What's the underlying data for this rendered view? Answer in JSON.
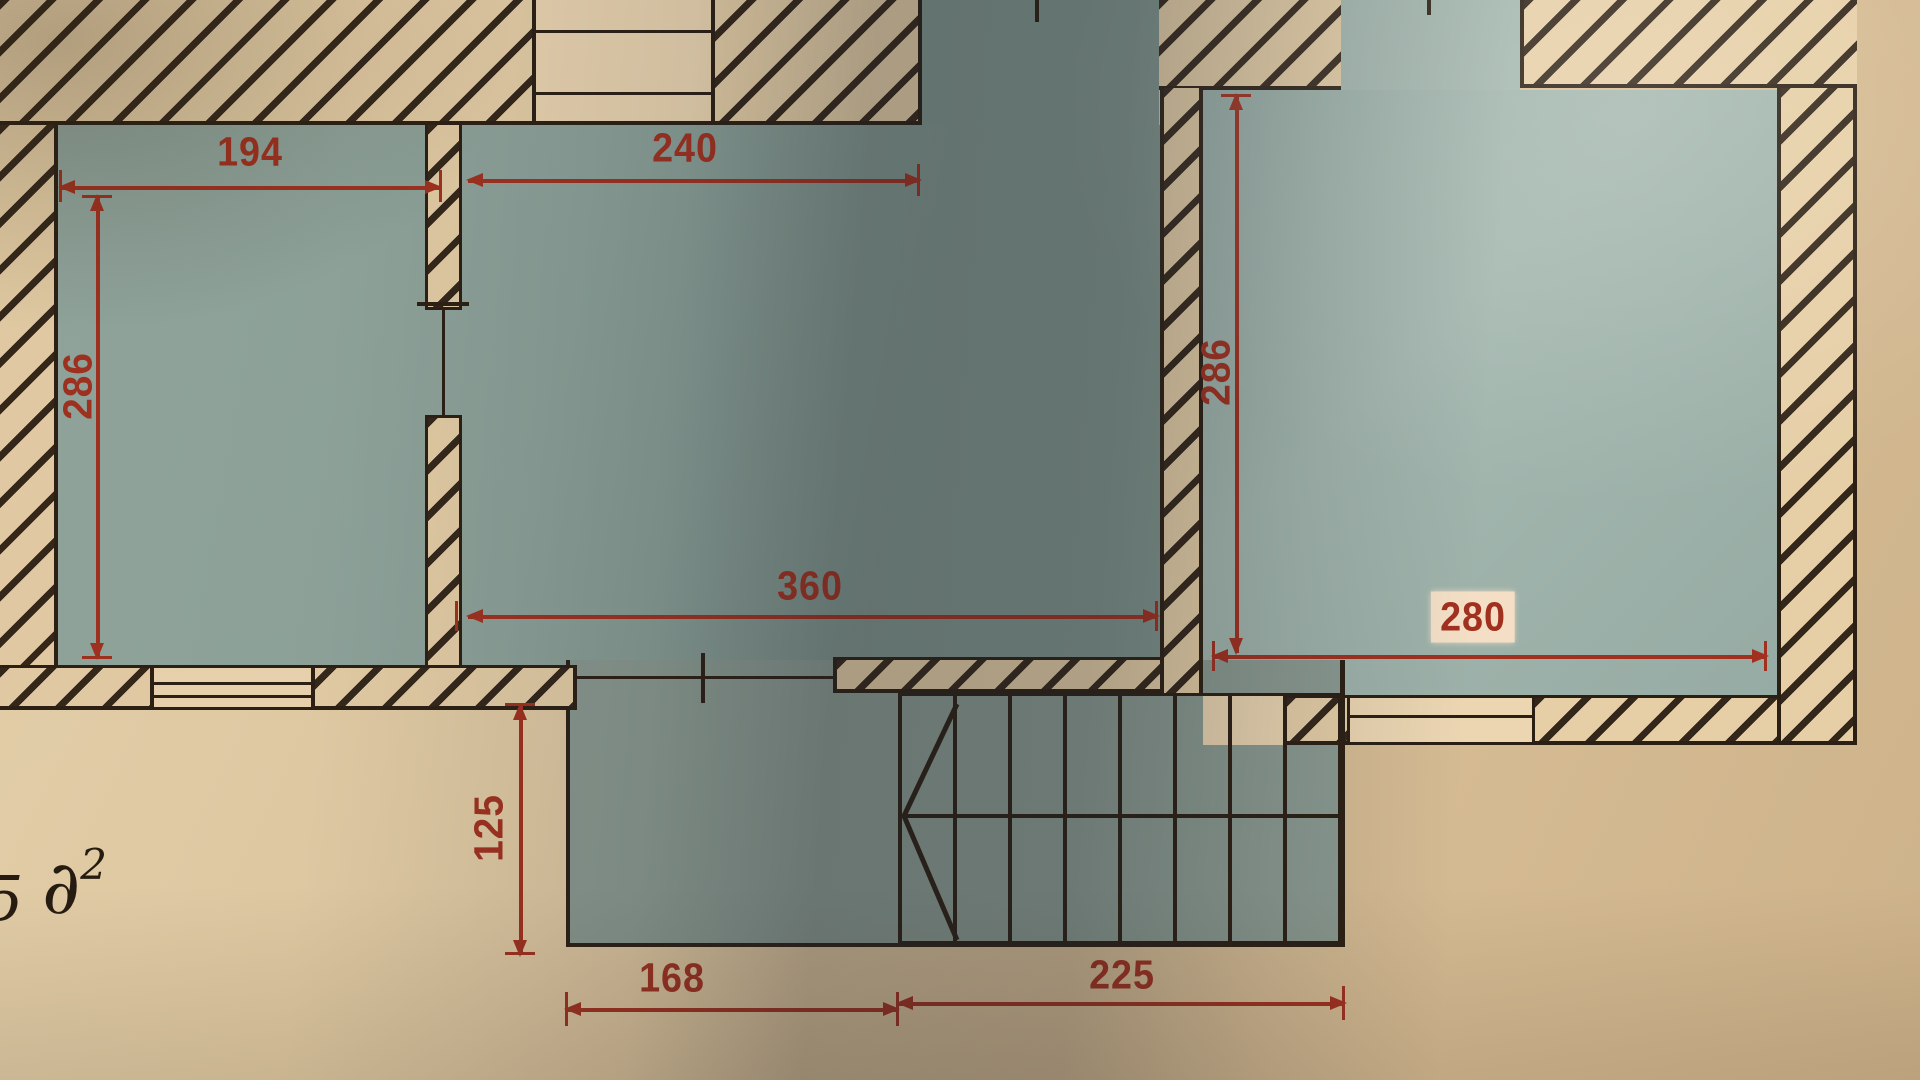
{
  "document": {
    "kind": "photographed floor plan drawing",
    "note": {
      "fragment": "5",
      "base": "∂",
      "sup": "2"
    }
  },
  "dimensions": {
    "room_left_width": "194",
    "top_wall_segment": "240",
    "room_left_height": "286",
    "room_right_height": "286",
    "room_middle_width": "360",
    "room_right_width": "280",
    "lower_extension_height": "125",
    "lower_extension_width": "168",
    "staircase_width": "225"
  },
  "features": [
    "hatched masonry walls",
    "left room",
    "middle room",
    "right room",
    "lower extension room",
    "staircase with break-line symbol",
    "window symbols in walls",
    "door openings with tick marks"
  ],
  "colors": {
    "paper": "#dfc7a1",
    "paper_light": "#ecd6b2",
    "room_fill": "#92a79f",
    "room_fill_light": "#a4b8b0",
    "wall_ink": "#2b1f14",
    "dimension_red": "#a1301f",
    "label_highlight": "#f4dfc6"
  }
}
